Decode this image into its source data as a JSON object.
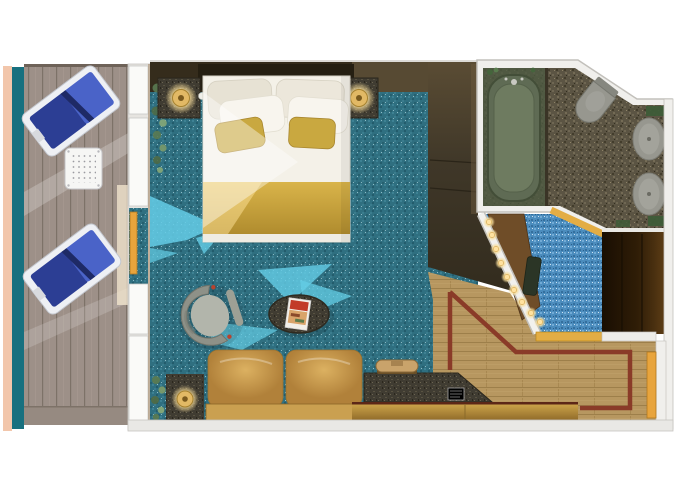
{
  "scene": {
    "type": "floor-plan",
    "subject": "cruise-ship balcony stateroom, top-down 3D rendering, no visible text",
    "rooms": [
      {
        "name": "balcony",
        "furniture": [
          "lounge-chair",
          "lounge-chair",
          "perforated-side-table",
          "wood-deck",
          "privacy-divider"
        ]
      },
      {
        "name": "bedroom",
        "furniture": [
          "double-bed",
          "white-pillows",
          "gold-accent-pillows",
          "gold-bed-runner",
          "nightstand-left",
          "nightstand-right",
          "table-lamp",
          "table-lamp",
          "tub-armchair",
          "oval-coffee-table",
          "magazine",
          "leather-sofa",
          "side-table-with-lamp",
          "plant",
          "wardrobe-tv-unit",
          "desk-with-phone",
          "notepad",
          "dresser-drawers"
        ]
      },
      {
        "name": "bathroom",
        "furniture": [
          "bathtub",
          "toilet",
          "sink",
          "sink",
          "green-counter-accents"
        ]
      },
      {
        "name": "dressing-area",
        "furniture": [
          "vanity-counter",
          "vanity-light-strip",
          "stool",
          "closet"
        ]
      },
      {
        "name": "entry-hall",
        "furniture": [
          "wood-floor-with-inlay-border",
          "cabin-door"
        ]
      }
    ]
  },
  "palette": {
    "wall_white": "#f0efec",
    "wall_edge": "#c2c0bb",
    "wall_dark_brown": "#352c1c",
    "wall_band_light": "#574a33",
    "hull_pink": "#f2c6ab",
    "divider_teal": "#17707f",
    "deck_base": "#9d9088",
    "carpet_teal": "#2f6f80",
    "carpet_blue": "#4b8cbd",
    "sunlight_cyan": "#64cde6",
    "wood_floor": "#b79760",
    "wood_inlay": "#8a3b28",
    "granite_floor": "#5b5443",
    "granite_furniture": "#403c32",
    "headboard": "#251f12",
    "bed_white": "#f4f1e8",
    "pillow_gold": "#c9a840",
    "sofa_tan": "#caa050",
    "chair_navy": "#2c3e94",
    "chair_blue": "#4a63c8",
    "armchair_gray": "#8e9188",
    "table_dark": "#4a4336",
    "tub_olive": "#5f6b54",
    "fixture_gray": "#97978f",
    "green_accent": "#3e5c38",
    "vanity_wood": "#6f4d28",
    "threshold_gold": "#e3ad45",
    "door_orange": "#e8a43c",
    "lamp_gold": "#e2b965"
  }
}
